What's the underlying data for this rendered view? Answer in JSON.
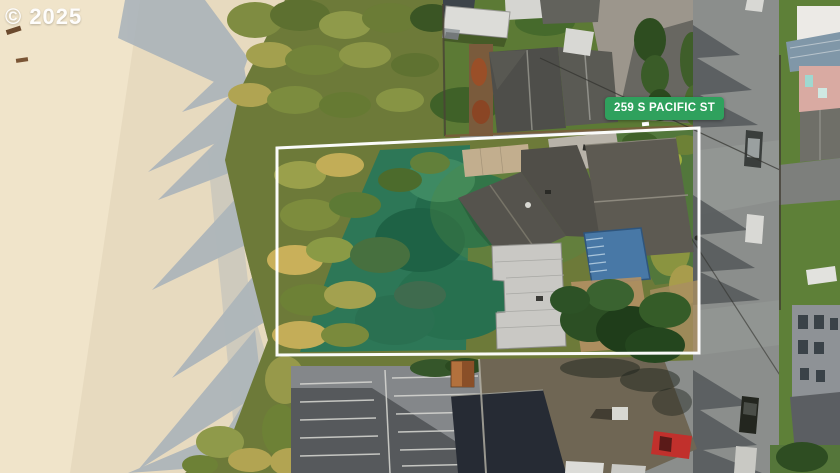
{
  "image": {
    "width": 840,
    "height": 473,
    "kind": "aerial-drone-photo",
    "subject": "beachfront property lot outlined in white beside S Pacific St"
  },
  "watermark": {
    "text": "© 2025"
  },
  "property_label": {
    "text": "259 S PACIFIC ST"
  },
  "palette": {
    "sand": "#e7dabf",
    "sand_bright": "#f0e4ca",
    "sand_shadow": "#a7b1ba",
    "vegetation": "#6d7a39",
    "lawn_teal": "#2d7757",
    "neighborhood_lawn": "#5c7a35",
    "road": "#8b8e8c",
    "road_shadow": "#54585a",
    "parking": "#84878a",
    "parking_shadow": "#56595c",
    "main_roof": "#55534d",
    "garage_roof": "#c9c8c4",
    "deck_blue": "#4878a6",
    "big_roof_sunlit": "#6f6654",
    "big_roof_shadow": "#262b34",
    "badge_green": "#2fa15d",
    "badge_text": "#ffffff",
    "boundary": "#ffffff",
    "watermark_text": "#ffffff"
  }
}
